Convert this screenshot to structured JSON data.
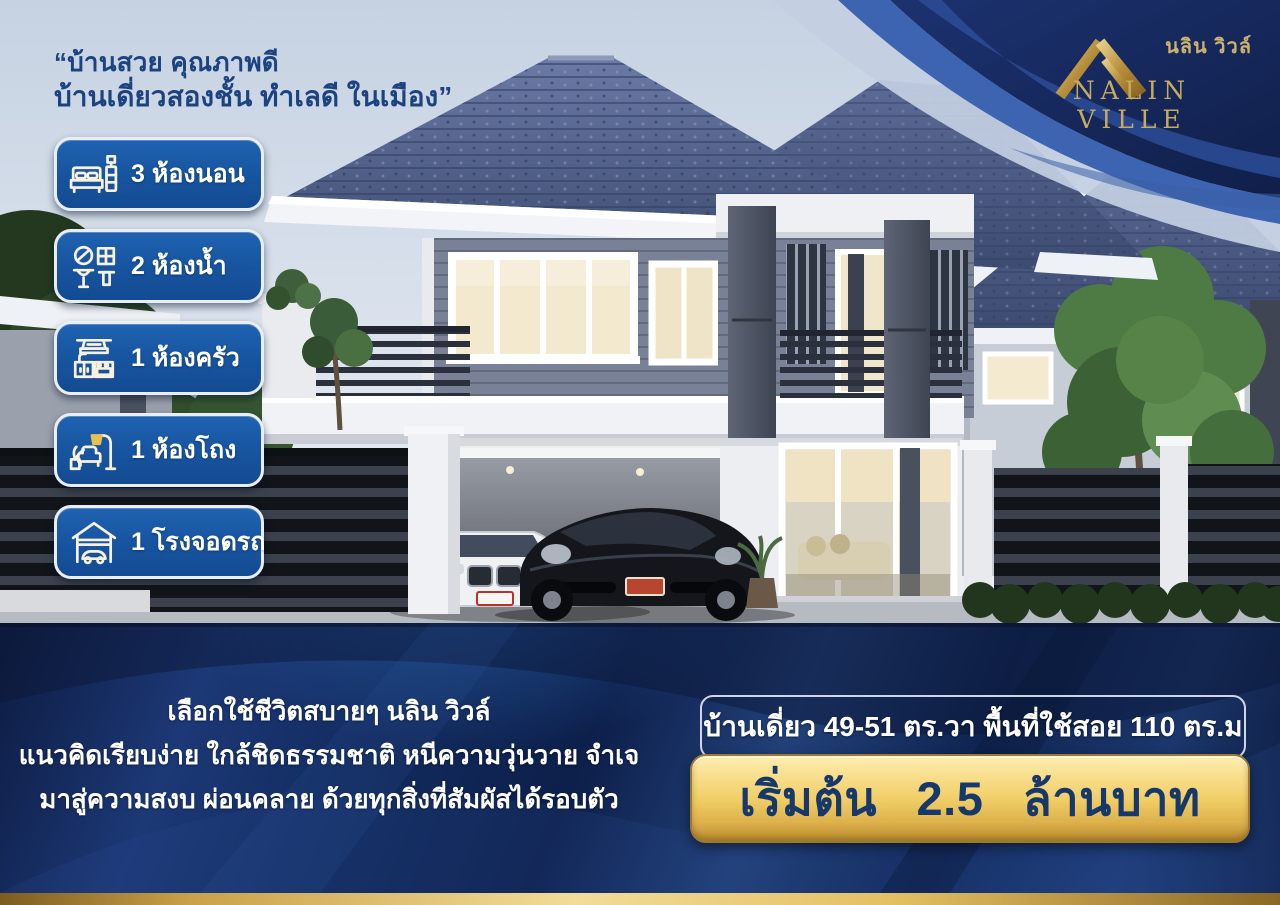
{
  "header": {
    "quote_line1": "“บ้านสวย คุณภาพดี",
    "quote_line2": "บ้านเดี่ยวสองชั้น ทำเลดี ในเมือง”"
  },
  "logo": {
    "thai_name": "นลิน วิวล์",
    "latin_name": "NALIN VILLE"
  },
  "features": [
    {
      "icon": "bed-icon",
      "label": "3 ห้องนอน"
    },
    {
      "icon": "bathroom-icon",
      "label": "2 ห้องน้ำ"
    },
    {
      "icon": "kitchen-icon",
      "label": "1 ห้องครัว"
    },
    {
      "icon": "living-room-icon",
      "label": "1 ห้องโถง"
    },
    {
      "icon": "garage-icon",
      "label": "1 โรงจอดรถ"
    }
  ],
  "description": {
    "line1": "เลือกใช้ชีวิตสบายๆ นลิน วิวล์",
    "line2": "แนวคิดเรียบง่าย ใกล้ชิดธรรมชาติ หนีความวุ่นวาย จำเจ",
    "line3": "มาสู่ความสงบ ผ่อนคลาย ด้วยทุกสิ่งที่สัมผัสได้รอบตัว"
  },
  "offer": {
    "spec_line": "บ้านเดี่ยว 49-51 ตร.วา พื้นที่ใช้สอย 110 ตร.ม",
    "price_line": "เริ่มต้น 2.5 ล้านบาท"
  },
  "colors": {
    "badge_blue": "#1856a2",
    "navy_band": "#112a5c",
    "gold_banner": "#f0cd66",
    "logo_gold": "#c7aa5e",
    "quote_text": "#1d4280",
    "roof_slate": "#4d5c88"
  }
}
